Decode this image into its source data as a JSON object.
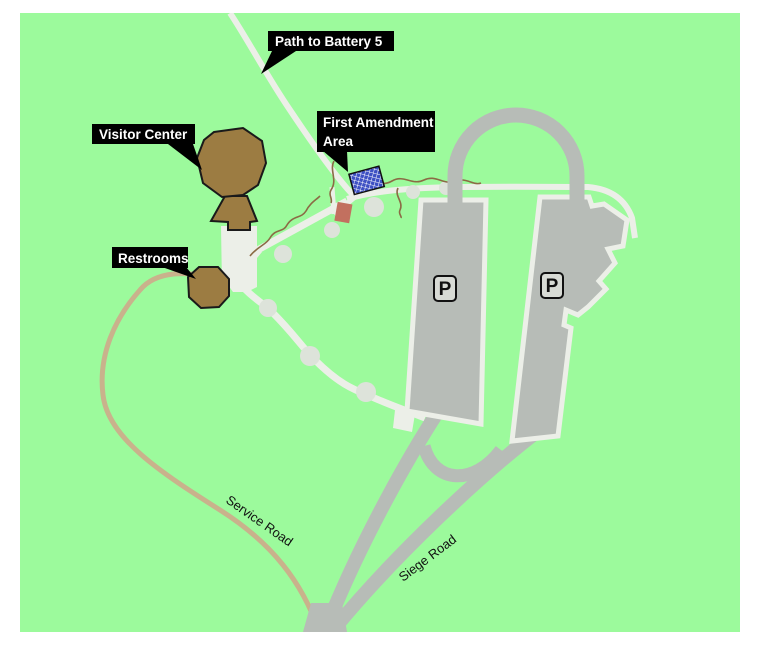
{
  "map": {
    "callouts": {
      "battery_path": "Path to Battery 5",
      "visitor_center": "Visitor Center",
      "first_amendment_line1": "First Amendment",
      "first_amendment_line2": "Area",
      "restrooms": "Restrooms"
    },
    "roads": {
      "service": "Service Road",
      "siege": "Siege Road"
    },
    "symbols": {
      "parking": "P"
    },
    "colors": {
      "grass_green": "#9CFA9C",
      "walkway_white": "#ECEFE8",
      "walkway_circle": "#DDE3DA",
      "road_gray": "#B7BCB7",
      "parking_sign_fill": "#D8DBD5",
      "building_brown": "#9C7C42",
      "service_road_tan": "#C9B28C",
      "fence_brown": "#8B6B45",
      "structure_red": "#C2705F",
      "first_amendment_blue": "#3D50C3",
      "label_bg": "#000000",
      "label_text": "#FFFFFF",
      "outline_black": "#1A1A1A"
    }
  }
}
